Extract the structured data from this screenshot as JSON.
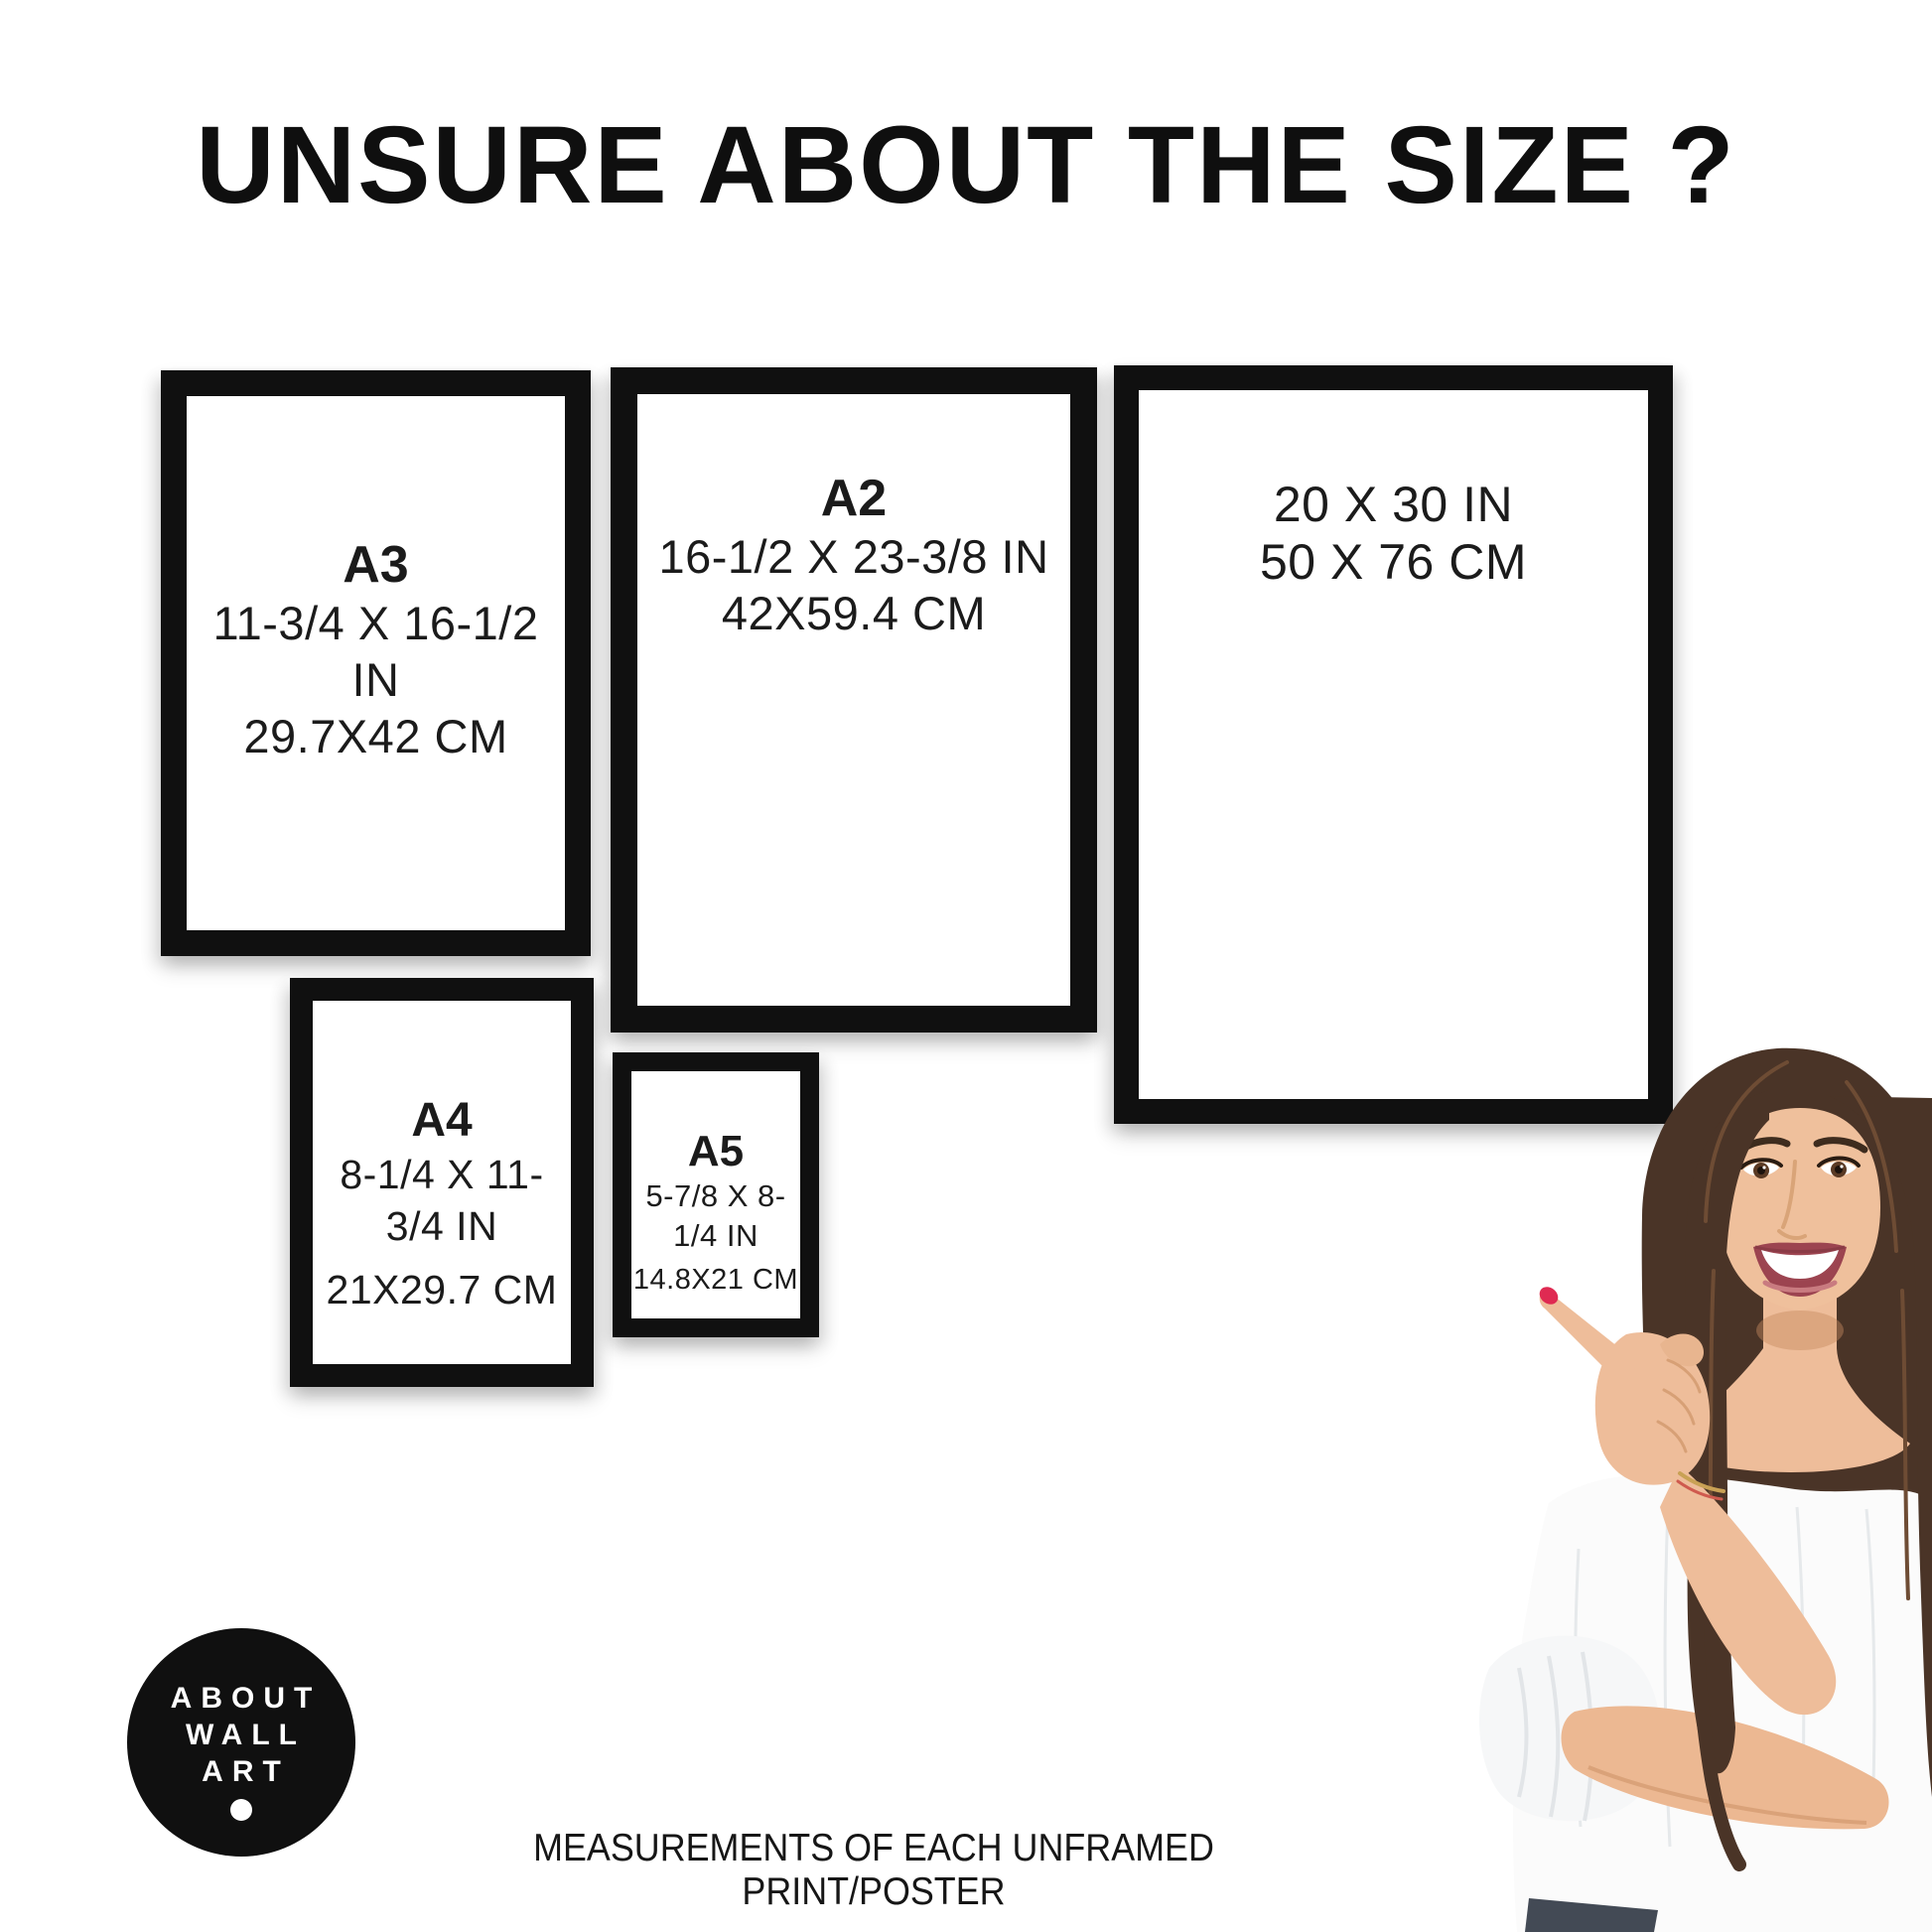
{
  "title": "UNSURE ABOUT THE SIZE ?",
  "frames": [
    {
      "label": "A3",
      "inches": "11-3/4 X 16-1/2 IN",
      "cm": "29.7X42 CM"
    },
    {
      "label": "A2",
      "inches": "16-1/2 X 23-3/8 IN",
      "cm": "42X59.4 CM"
    },
    {
      "inches": "20 X 30 IN",
      "cm": "50 X 76 CM"
    },
    {
      "label": "A4",
      "inches": "8-1/4 X 11-3/4 IN",
      "cm": "21X29.7 CM"
    },
    {
      "label": "A5",
      "inches": "5-7/8 X 8-1/4 IN",
      "cm": "14.8X21 CM"
    }
  ],
  "logo": {
    "line1": "ABOUT",
    "line2": "WALL",
    "line3": "ART"
  },
  "caption": "MEASUREMENTS OF EACH UNFRAMED PRINT/POSTER",
  "colors": {
    "background": "#ffffff",
    "frame_black": "#101010",
    "text": "#1a1a1a",
    "logo_background": "#101010",
    "logo_text": "#ffffff",
    "nail_red": "#df2a52"
  }
}
